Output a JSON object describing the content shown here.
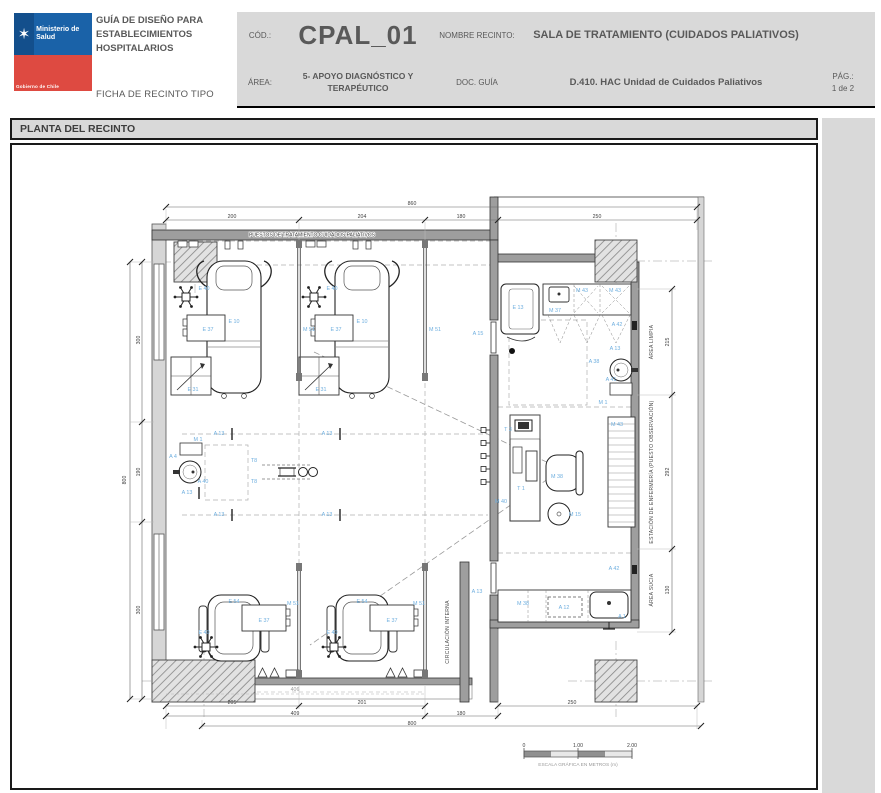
{
  "header": {
    "logo": {
      "ministry": "Ministerio de Salud",
      "government": "Gobierno de Chile"
    },
    "title": "GUÍA DE DISEÑO PARA ESTABLECIMIENTOS HOSPITALARIOS",
    "subtitle": "FICHA DE RECINTO TIPO",
    "fields": {
      "cod_label": "CÓD.:",
      "cod_value": "CPAL_01",
      "area_label": "ÁREA:",
      "area_value": "5- APOYO DIAGNÓSTICO Y TERAPÉUTICO",
      "nombre_label": "NOMBRE RECINTO:",
      "nombre_value": "SALA DE TRATAMIENTO (CUIDADOS PALIATIVOS)",
      "doc_label": "DOC. GUÍA",
      "doc_value": "D.410. HAC Unidad de Cuidados Paliativos",
      "pag_label": "PÁG.:",
      "pag_value": "1 de 2"
    }
  },
  "section": {
    "title": "PLANTA DEL RECINTO"
  },
  "plan": {
    "colors": {
      "tag": "#6FAFDF",
      "wall": "#9E9E9E",
      "light_wall": "#D6D6D6"
    },
    "top_note": {
      "t": "PUESTOS DE TRATAMIENTO CUIDADOS PALIATIVOS",
      "x": 300,
      "y": 91.5
    },
    "areas": [
      {
        "t": "ÁREA LIMPIA",
        "x": 641,
        "y": 197,
        "r": -90,
        "s": 5
      },
      {
        "t": "ESTACIÓN DE ENFERMERÍA  (PUESTO OBSERVACIÓN)",
        "x": 641,
        "y": 327,
        "r": -90,
        "s": 4.4
      },
      {
        "t": "ÁREA SUCIA",
        "x": 641,
        "y": 445,
        "r": -90,
        "s": 5
      },
      {
        "t": "CIRCULACIÓN INTERNA",
        "x": 437,
        "y": 487,
        "r": -90,
        "s": 7,
        "c": "#b5b5b5"
      }
    ],
    "tags": [
      {
        "t": "E 40",
        "x": 192,
        "y": 145
      },
      {
        "t": "E 10",
        "x": 222,
        "y": 178
      },
      {
        "t": "E 37",
        "x": 196,
        "y": 186
      },
      {
        "t": "E 31",
        "x": 181,
        "y": 246
      },
      {
        "t": "M 51",
        "x": 297,
        "y": 186
      },
      {
        "t": "E 40",
        "x": 320,
        "y": 145
      },
      {
        "t": "E 10",
        "x": 350,
        "y": 178
      },
      {
        "t": "E 37",
        "x": 324,
        "y": 186
      },
      {
        "t": "E 31",
        "x": 309,
        "y": 246
      },
      {
        "t": "M 51",
        "x": 423,
        "y": 186
      },
      {
        "t": "M 1",
        "x": 186,
        "y": 296
      },
      {
        "t": "A 4",
        "x": 161,
        "y": 313
      },
      {
        "t": "A 40",
        "x": 191,
        "y": 338
      },
      {
        "t": "A 13",
        "x": 175,
        "y": 349
      },
      {
        "t": "T8",
        "x": 242,
        "y": 317
      },
      {
        "t": "T8",
        "x": 242,
        "y": 338
      },
      {
        "t": "A 13",
        "x": 207,
        "y": 290
      },
      {
        "t": "A 13",
        "x": 315,
        "y": 290
      },
      {
        "t": "A 13",
        "x": 207,
        "y": 371
      },
      {
        "t": "A 13",
        "x": 315,
        "y": 371
      },
      {
        "t": "E 54",
        "x": 222,
        "y": 458
      },
      {
        "t": "E 37",
        "x": 252,
        "y": 477
      },
      {
        "t": "E 40",
        "x": 192,
        "y": 489
      },
      {
        "t": "M 51",
        "x": 281,
        "y": 460
      },
      {
        "t": "E 54",
        "x": 350,
        "y": 458
      },
      {
        "t": "E 37",
        "x": 380,
        "y": 477
      },
      {
        "t": "E 40",
        "x": 320,
        "y": 489
      },
      {
        "t": "M 51",
        "x": 407,
        "y": 460
      },
      {
        "t": "A 15",
        "x": 466,
        "y": 190
      },
      {
        "t": "E 13",
        "x": 506,
        "y": 164
      },
      {
        "t": "M 37",
        "x": 543,
        "y": 167
      },
      {
        "t": "M 43",
        "x": 570,
        "y": 147
      },
      {
        "t": "M 43",
        "x": 603,
        "y": 147
      },
      {
        "t": "A 42",
        "x": 605,
        "y": 181
      },
      {
        "t": "A 13",
        "x": 603,
        "y": 205
      },
      {
        "t": "A 38",
        "x": 582,
        "y": 218
      },
      {
        "t": "A 41",
        "x": 599,
        "y": 236
      },
      {
        "t": "M 1",
        "x": 591,
        "y": 259
      },
      {
        "t": "T 3",
        "x": 496,
        "y": 286
      },
      {
        "t": "T 1",
        "x": 509,
        "y": 345
      },
      {
        "t": "M 40",
        "x": 489,
        "y": 358
      },
      {
        "t": "M 38",
        "x": 545,
        "y": 333
      },
      {
        "t": "M 15",
        "x": 563,
        "y": 371
      },
      {
        "t": "M 43",
        "x": 605,
        "y": 281
      },
      {
        "t": "M 38",
        "x": 511,
        "y": 460
      },
      {
        "t": "A 12",
        "x": 552,
        "y": 464
      },
      {
        "t": "A 1",
        "x": 610,
        "y": 473
      },
      {
        "t": "A 42",
        "x": 602,
        "y": 425
      },
      {
        "t": "A 13",
        "x": 465,
        "y": 448
      }
    ],
    "dims": [
      {
        "t": "860",
        "x": 400,
        "y": 60
      },
      {
        "t": "200",
        "x": 220,
        "y": 73
      },
      {
        "t": "204",
        "x": 350,
        "y": 73
      },
      {
        "t": "180",
        "x": 449,
        "y": 73
      },
      {
        "t": "250",
        "x": 585,
        "y": 73
      },
      {
        "t": "800",
        "x": 114,
        "y": 335,
        "r": -90
      },
      {
        "t": "300",
        "x": 128,
        "y": 195,
        "r": -90
      },
      {
        "t": "190",
        "x": 128,
        "y": 327,
        "r": -90
      },
      {
        "t": "300",
        "x": 128,
        "y": 465,
        "r": -90
      },
      {
        "t": "215",
        "x": 657,
        "y": 197,
        "r": -90
      },
      {
        "t": "292",
        "x": 657,
        "y": 327,
        "r": -90
      },
      {
        "t": "130",
        "x": 657,
        "y": 445,
        "r": -90
      },
      {
        "t": "406",
        "x": 283,
        "y": 546,
        "light": true
      },
      {
        "t": "205",
        "x": 220,
        "y": 559
      },
      {
        "t": "201",
        "x": 350,
        "y": 559
      },
      {
        "t": "250",
        "x": 560,
        "y": 559
      },
      {
        "t": "409",
        "x": 283,
        "y": 570
      },
      {
        "t": "180",
        "x": 449,
        "y": 570
      },
      {
        "t": "800",
        "x": 400,
        "y": 580
      }
    ],
    "scale_bar": {
      "ticks_y": 602,
      "ticks": [
        {
          "t": "0",
          "x": 512
        },
        {
          "t": "1.00",
          "x": 566
        },
        {
          "t": "2.00",
          "x": 620
        }
      ],
      "caption": {
        "t": "ESCALA GRÁFICA EN METROS (m)",
        "x": 566,
        "y": 621
      }
    }
  }
}
